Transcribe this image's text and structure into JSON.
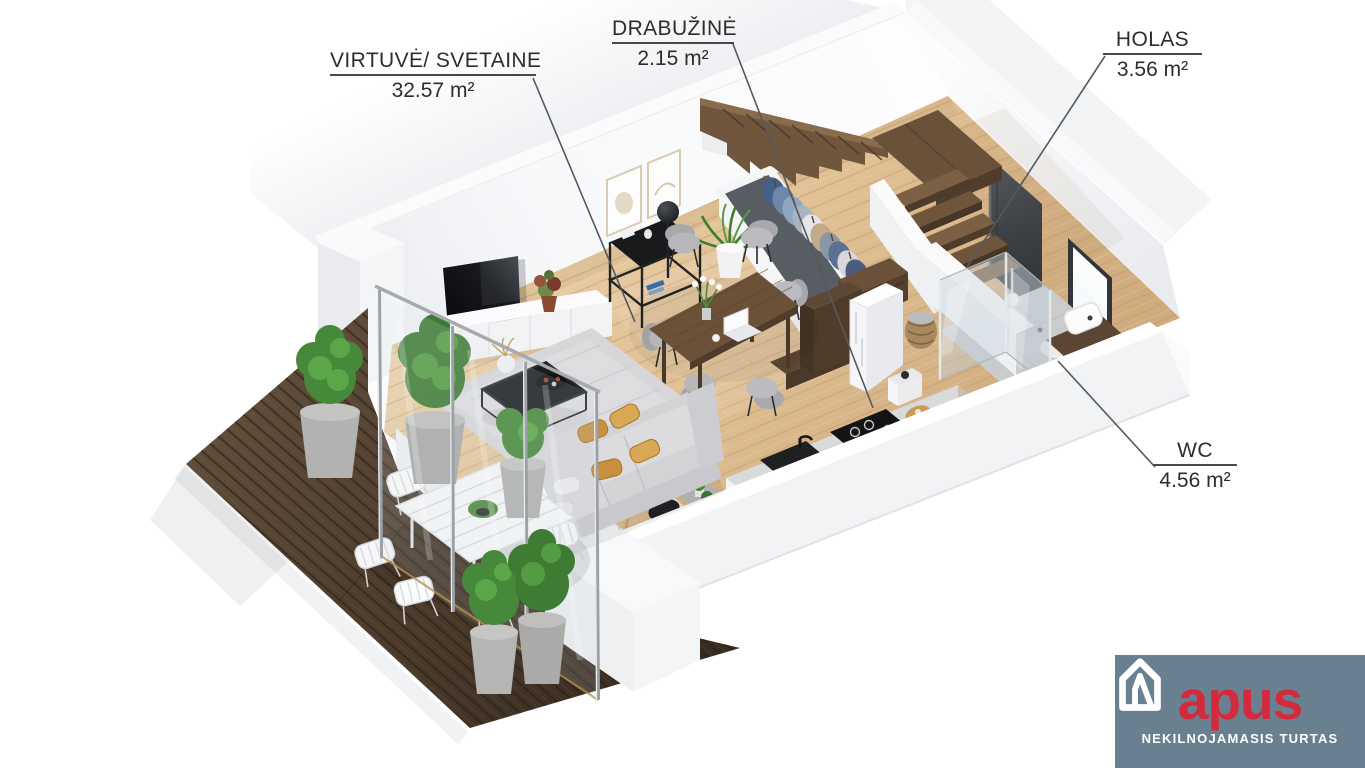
{
  "page": {
    "background": "#FFFFFF",
    "width": 1365,
    "height": 768,
    "type": "3d-floor-plan-render"
  },
  "labels": [
    {
      "id": "kitchen-living",
      "label": "VIRTUVĖ/ SVETAINE",
      "area": "32.57 m²"
    },
    {
      "id": "wardrobe",
      "label": "DRABUŽINĖ",
      "area": "2.15 m²"
    },
    {
      "id": "hall",
      "label": "HOLAS",
      "area": "3.56 m²"
    },
    {
      "id": "wc",
      "label": "WC",
      "area": "4.56 m²"
    }
  ],
  "logo": {
    "brand": "apus",
    "tagline": "NEKILNOJAMASIS TURTAS",
    "background": "#68808F",
    "brand_color": "#D5293D",
    "tagline_color": "#FFFFFF",
    "icon": "house-icon"
  },
  "palette": {
    "wall": "#F4F5F7",
    "floor_wood": "#E2C59A",
    "deck_wood": "#4E3D2E",
    "stair_wood": "#6E553C",
    "plant_green": "#4E9340",
    "label_text": "#2D2D2E",
    "leader_line": "#55595C"
  }
}
